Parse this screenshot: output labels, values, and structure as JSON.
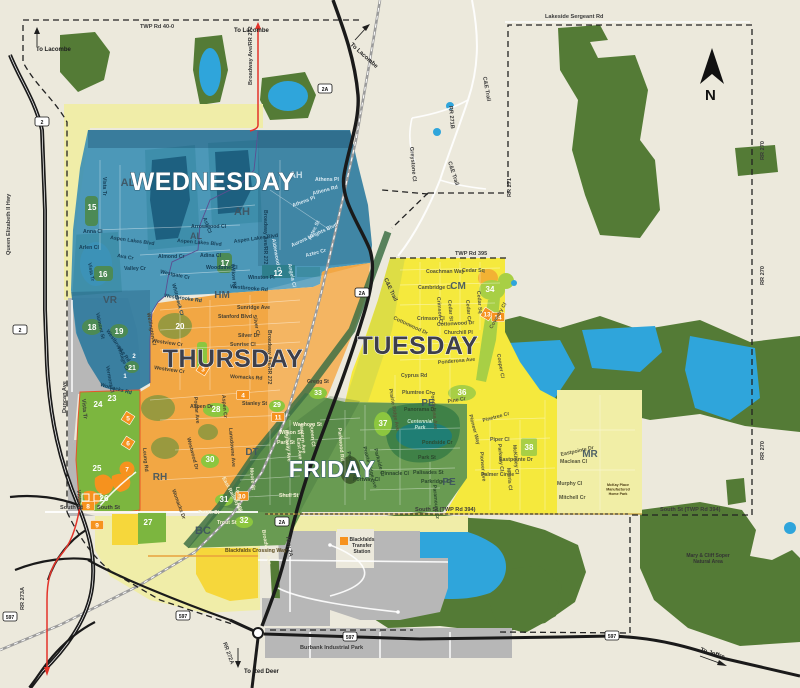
{
  "compass_letter": "N",
  "colors": {
    "background": "#ECE9DC",
    "forest": "#547B36",
    "lake": "#2FA5DB",
    "wednesday_blue": "#3E90B4",
    "thursday_orange": "#F2A744",
    "tuesday_yellow": "#F5E93D",
    "friday_green": "#699B52",
    "residential_green": "#7CB63F",
    "pale_yellow": "#F0EDA8",
    "gray": "#B7B7B7",
    "red_road": "#E33329",
    "marker_orange": "#F6921E"
  },
  "zone_titles": [
    {
      "id": "wednesday",
      "label": "WEDNESDAY",
      "x": 213,
      "y": 190,
      "size": 25,
      "style": "light"
    },
    {
      "id": "thursday",
      "label": "THURSDAY",
      "x": 233,
      "y": 367,
      "size": 25,
      "style": "dark"
    },
    {
      "id": "tuesday",
      "label": "TUESDAY",
      "x": 418,
      "y": 354,
      "size": 25,
      "style": "dark"
    },
    {
      "id": "friday",
      "label": "FRIDAY",
      "x": 332,
      "y": 477,
      "size": 23,
      "style": "light"
    }
  ],
  "area_codes": [
    {
      "t": "AL",
      "x": 128,
      "y": 186,
      "s": 11
    },
    {
      "t": "AH",
      "x": 242,
      "y": 215,
      "s": 11
    },
    {
      "t": "AH",
      "x": 296,
      "y": 178,
      "s": 9,
      "c": "w"
    },
    {
      "t": "AL",
      "x": 196,
      "y": 239,
      "s": 9
    },
    {
      "t": "VR",
      "x": 110,
      "y": 303,
      "s": 10
    },
    {
      "t": "HM",
      "x": 222,
      "y": 298,
      "s": 10
    },
    {
      "t": "RH",
      "x": 160,
      "y": 480,
      "s": 10
    },
    {
      "t": "CM",
      "x": 458,
      "y": 289,
      "s": 10
    },
    {
      "t": "PE",
      "x": 428,
      "y": 406,
      "s": 10
    },
    {
      "t": "PE",
      "x": 449,
      "y": 485,
      "s": 10
    },
    {
      "t": "DT",
      "x": 252,
      "y": 455,
      "s": 10
    },
    {
      "t": "MR",
      "x": 590,
      "y": 457,
      "s": 10
    },
    {
      "t": "BC",
      "x": 203,
      "y": 534,
      "s": 11
    }
  ],
  "park_numbers": [
    {
      "t": "15",
      "x": 92,
      "y": 210
    },
    {
      "t": "16",
      "x": 103,
      "y": 277
    },
    {
      "t": "17",
      "x": 225,
      "y": 266
    },
    {
      "t": "12",
      "x": 278,
      "y": 276
    },
    {
      "t": "18",
      "x": 92,
      "y": 330
    },
    {
      "t": "19",
      "x": 119,
      "y": 334
    },
    {
      "t": "21",
      "x": 132,
      "y": 370,
      "s": 7
    },
    {
      "t": "2",
      "x": 134,
      "y": 358,
      "s": 6
    },
    {
      "t": "1",
      "x": 125,
      "y": 378,
      "s": 6
    },
    {
      "t": "20",
      "x": 180,
      "y": 329
    },
    {
      "t": "23",
      "x": 112,
      "y": 401
    },
    {
      "t": "24",
      "x": 98,
      "y": 407
    },
    {
      "t": "25",
      "x": 97,
      "y": 471
    },
    {
      "t": "26",
      "x": 104,
      "y": 501
    },
    {
      "t": "27",
      "x": 148,
      "y": 525
    },
    {
      "t": "28",
      "x": 216,
      "y": 412
    },
    {
      "t": "29",
      "x": 277,
      "y": 407,
      "s": 7
    },
    {
      "t": "30",
      "x": 210,
      "y": 462
    },
    {
      "t": "31",
      "x": 224,
      "y": 502
    },
    {
      "t": "32",
      "x": 244,
      "y": 523
    },
    {
      "t": "33",
      "x": 318,
      "y": 395,
      "s": 7
    },
    {
      "t": "34",
      "x": 490,
      "y": 292
    },
    {
      "t": "36",
      "x": 462,
      "y": 395
    },
    {
      "t": "37",
      "x": 383,
      "y": 426
    },
    {
      "t": "38",
      "x": 529,
      "y": 450
    }
  ],
  "orange_markers": [
    {
      "t": "3",
      "x": 203,
      "y": 369,
      "shape": "diamond"
    },
    {
      "t": "5",
      "x": 128,
      "y": 418,
      "shape": "diamond"
    },
    {
      "t": "6",
      "x": 128,
      "y": 443,
      "shape": "diamond"
    },
    {
      "t": "7",
      "x": 127,
      "y": 469,
      "shape": "blob"
    },
    {
      "t": "8",
      "x": 88,
      "y": 506,
      "shape": "box"
    },
    {
      "t": "9",
      "x": 97,
      "y": 525,
      "shape": "box"
    },
    {
      "t": "4",
      "x": 243,
      "y": 395,
      "shape": "box"
    },
    {
      "t": "10",
      "x": 242,
      "y": 496,
      "shape": "box"
    },
    {
      "t": "11",
      "x": 278,
      "y": 417,
      "shape": "box"
    },
    {
      "t": "13",
      "x": 487,
      "y": 314,
      "shape": "diamond"
    },
    {
      "t": "14",
      "x": 498,
      "y": 317,
      "shape": "box"
    }
  ],
  "highway_shields": [
    {
      "t": "2",
      "x": 42,
      "y": 122
    },
    {
      "t": "2",
      "x": 20,
      "y": 330
    },
    {
      "t": "2A",
      "x": 325,
      "y": 89
    },
    {
      "t": "2A",
      "x": 362,
      "y": 293
    },
    {
      "t": "2A",
      "x": 282,
      "y": 522
    },
    {
      "t": "597",
      "x": 10,
      "y": 617
    },
    {
      "t": "597",
      "x": 183,
      "y": 616
    },
    {
      "t": "597",
      "x": 350,
      "y": 637
    },
    {
      "t": "597",
      "x": 612,
      "y": 636
    }
  ],
  "road_labels": [
    {
      "t": "TWP Rd 40-0",
      "x": 140,
      "y": 28
    },
    {
      "t": "Lakeside Sergeant Rd",
      "x": 545,
      "y": 18
    },
    {
      "t": "TWP Rd 395",
      "x": 455,
      "y": 255
    },
    {
      "t": "South St (TWP Rd 394)",
      "x": 415,
      "y": 511
    },
    {
      "t": "South St (TWP Rd 394)",
      "x": 660,
      "y": 511
    },
    {
      "t": "South St",
      "x": 60,
      "y": 509
    },
    {
      "t": "South St",
      "x": 97,
      "y": 509
    },
    {
      "t": "Queen Elizabeth II Hwy",
      "x": 10,
      "y": 255,
      "r": -90
    },
    {
      "t": "Broadway Ave/RR 272",
      "x": 252,
      "y": 85,
      "r": -90
    },
    {
      "t": "C&E Trail",
      "x": 483,
      "y": 77,
      "r": 80
    },
    {
      "t": "C&E Trail",
      "x": 448,
      "y": 162,
      "r": 72
    },
    {
      "t": "C&E Trail",
      "x": 384,
      "y": 279,
      "r": 65
    },
    {
      "t": "RR 271B",
      "x": 449,
      "y": 106,
      "r": 85
    },
    {
      "t": "RR 271",
      "x": 511,
      "y": 197,
      "r": -90
    },
    {
      "t": "RR 270",
      "x": 764,
      "y": 160,
      "r": -90
    },
    {
      "t": "RR 270",
      "x": 764,
      "y": 285,
      "r": -90
    },
    {
      "t": "RR 270",
      "x": 764,
      "y": 460,
      "r": -90
    },
    {
      "t": "RR 273A",
      "x": 24,
      "y": 610,
      "r": -90
    },
    {
      "t": "RR 272A",
      "x": 223,
      "y": 643,
      "r": 70
    },
    {
      "t": "Hwy 2A",
      "x": 286,
      "y": 537,
      "r": 80
    },
    {
      "t": "Greystone Cl",
      "x": 410,
      "y": 147,
      "r": 85
    },
    {
      "t": "Duncan Ave",
      "x": 66,
      "y": 413,
      "r": -90
    },
    {
      "t": "Vista Tr",
      "x": 82,
      "y": 399,
      "r": 85
    },
    {
      "t": "Vista Tr",
      "x": 77,
      "y": 490,
      "r": 85
    },
    {
      "t": "Burbank Industrial Park",
      "x": 300,
      "y": 649
    }
  ],
  "direction_labels": [
    {
      "t": "To Lacombe",
      "x": 36,
      "y": 51
    },
    {
      "t": "To Lacombe",
      "x": 234,
      "y": 32
    },
    {
      "t": "To Lacombe",
      "x": 350,
      "y": 45,
      "r": 42
    },
    {
      "t": "To Red Deer",
      "x": 244,
      "y": 673
    },
    {
      "t": "To Joffre",
      "x": 700,
      "y": 651,
      "r": 18
    }
  ],
  "place_labels": [
    {
      "lines": [
        "Blackfalds",
        "Transfer",
        "Station"
      ],
      "x": 362,
      "y": 541,
      "cls": "place"
    },
    {
      "lines": [
        "Mary & Cliff Soper",
        "Natural Area"
      ],
      "x": 708,
      "y": 557,
      "cls": "place"
    },
    {
      "lines": [
        "Centennial",
        "Park"
      ],
      "x": 420,
      "y": 423,
      "cls": "park-label"
    },
    {
      "lines": [
        "McKay Place",
        "Manufactured",
        "Home Park"
      ],
      "x": 618,
      "y": 486,
      "cls": "tiny"
    }
  ],
  "street_labels": [
    {
      "t": "Vista Tr",
      "x": 103,
      "y": 177,
      "r": 90,
      "c": "b"
    },
    {
      "t": "Anna Cl",
      "x": 83,
      "y": 233,
      "c": "b"
    },
    {
      "t": "Aspen Lakes Blvd",
      "x": 110,
      "y": 239,
      "r": 8,
      "c": "b"
    },
    {
      "t": "Arlen Cl",
      "x": 79,
      "y": 249,
      "c": "b"
    },
    {
      "t": "Ava Cr",
      "x": 117,
      "y": 257,
      "r": 10,
      "c": "b"
    },
    {
      "t": "Valley Cr",
      "x": 124,
      "y": 270,
      "c": "b"
    },
    {
      "t": "Vista Tr",
      "x": 88,
      "y": 263,
      "r": 80,
      "c": "b"
    },
    {
      "t": "Valmont St",
      "x": 96,
      "y": 313,
      "r": 78,
      "c": "b"
    },
    {
      "t": "Westbrooke Rd",
      "x": 106,
      "y": 331,
      "r": 55,
      "c": "b"
    },
    {
      "t": "Vintage Cl",
      "x": 117,
      "y": 347,
      "r": 70,
      "c": "b"
    },
    {
      "t": "Vermont Cl",
      "x": 106,
      "y": 366,
      "r": 80,
      "c": "b"
    },
    {
      "t": "Womacks Rd",
      "x": 100,
      "y": 386,
      "r": 15,
      "c": "b"
    },
    {
      "t": "Almond Cr",
      "x": 158,
      "y": 258,
      "c": "b"
    },
    {
      "t": "Westgate Cr",
      "x": 160,
      "y": 273,
      "r": 12,
      "c": "b"
    },
    {
      "t": "Whitebeck Cl",
      "x": 172,
      "y": 284,
      "r": 75,
      "c": "b"
    },
    {
      "t": "Westbrooke Rd",
      "x": 164,
      "y": 297,
      "r": 8,
      "c": "b"
    },
    {
      "t": "Arrowwood Cl",
      "x": 191,
      "y": 228,
      "c": "b"
    },
    {
      "t": "Ash Cl",
      "x": 203,
      "y": 218,
      "r": 70,
      "c": "b"
    },
    {
      "t": "Aspen Lakes Blvd",
      "x": 177,
      "y": 242,
      "r": 5,
      "c": "b"
    },
    {
      "t": "Adina Cl",
      "x": 200,
      "y": 257,
      "c": "b"
    },
    {
      "t": "Woodbine Cl",
      "x": 206,
      "y": 269,
      "c": "b"
    },
    {
      "t": "Willow Rd",
      "x": 231,
      "y": 264,
      "r": 85,
      "c": "b"
    },
    {
      "t": "Aspen Lakes Blvd",
      "x": 234,
      "y": 243,
      "r": -8,
      "c": "b"
    },
    {
      "t": "Winston Pl",
      "x": 248,
      "y": 279,
      "c": "b"
    },
    {
      "t": "Westbrooke Rd",
      "x": 230,
      "y": 288,
      "r": 5,
      "c": "b"
    },
    {
      "t": "Broadway Ave/RR 272",
      "x": 264,
      "y": 210,
      "r": 90,
      "c": "b"
    },
    {
      "t": "Athens Pl",
      "x": 315,
      "y": 181,
      "c": "w"
    },
    {
      "t": "Athens Rd",
      "x": 313,
      "y": 195,
      "r": -15,
      "c": "w"
    },
    {
      "t": "Athens Pl",
      "x": 293,
      "y": 207,
      "r": -20,
      "c": "w"
    },
    {
      "t": "Alderwood Cl",
      "x": 272,
      "y": 239,
      "r": 80,
      "c": "w"
    },
    {
      "t": "Aurora Heights Blvd",
      "x": 292,
      "y": 247,
      "r": -25,
      "c": "w"
    },
    {
      "t": "Aztec St",
      "x": 311,
      "y": 240,
      "r": -65,
      "c": "w"
    },
    {
      "t": "Aztec Cr",
      "x": 306,
      "y": 257,
      "r": -15,
      "c": "w"
    },
    {
      "t": "Angela Cl",
      "x": 288,
      "y": 264,
      "r": 78,
      "c": "w"
    },
    {
      "t": "Wellington Cl",
      "x": 147,
      "y": 313,
      "r": 80,
      "c": "o"
    },
    {
      "t": "Westview Cr",
      "x": 152,
      "y": 342,
      "r": 8,
      "c": "o"
    },
    {
      "t": "Westview Cr",
      "x": 154,
      "y": 369,
      "r": 8,
      "c": "o"
    },
    {
      "t": "Womacks Rd",
      "x": 230,
      "y": 378,
      "r": 3,
      "c": "o"
    },
    {
      "t": "Stanford Blvd",
      "x": 218,
      "y": 318,
      "c": "o"
    },
    {
      "t": "Sunridge Ave",
      "x": 237,
      "y": 309,
      "c": "o"
    },
    {
      "t": "Silver Dr",
      "x": 238,
      "y": 337,
      "c": "o"
    },
    {
      "t": "Sunrise Cl",
      "x": 230,
      "y": 346,
      "c": "o"
    },
    {
      "t": "Silver Cl",
      "x": 253,
      "y": 315,
      "r": 80,
      "c": "o"
    },
    {
      "t": "Gregg St",
      "x": 307,
      "y": 383,
      "c": "o"
    },
    {
      "t": "Stanley St",
      "x": 242,
      "y": 405,
      "c": "o"
    },
    {
      "t": "Aspen Dr",
      "x": 190,
      "y": 408,
      "c": "o"
    },
    {
      "t": "Poplar Ave",
      "x": 194,
      "y": 397,
      "r": 85,
      "c": "o"
    },
    {
      "t": "Aspen Cr",
      "x": 222,
      "y": 395,
      "r": 85,
      "c": "o"
    },
    {
      "t": "Lansdowne Ave",
      "x": 229,
      "y": 428,
      "r": 85,
      "c": "o"
    },
    {
      "t": "Leung Rd",
      "x": 143,
      "y": 448,
      "r": 85,
      "c": "o"
    },
    {
      "t": "Womacks Dr",
      "x": 172,
      "y": 490,
      "r": 70,
      "c": "o"
    },
    {
      "t": "Westwood Dr",
      "x": 187,
      "y": 438,
      "r": 75,
      "c": "o"
    },
    {
      "t": "Broadway Ave/RR 272",
      "x": 268,
      "y": 330,
      "r": 90,
      "c": "o"
    },
    {
      "t": "Coachman Way",
      "x": 426,
      "y": 273,
      "c": "y"
    },
    {
      "t": "Cedar Sq",
      "x": 462,
      "y": 272,
      "c": "y"
    },
    {
      "t": "Cambridge Cl",
      "x": 418,
      "y": 289,
      "c": "y"
    },
    {
      "t": "Cedar St",
      "x": 448,
      "y": 300,
      "r": 85,
      "c": "y"
    },
    {
      "t": "Cedar Cr",
      "x": 466,
      "y": 300,
      "r": 85,
      "c": "y"
    },
    {
      "t": "Cedar Sq",
      "x": 477,
      "y": 291,
      "r": 85,
      "c": "y"
    },
    {
      "t": "Crimson Cl",
      "x": 437,
      "y": 297,
      "r": 85,
      "c": "y"
    },
    {
      "t": "Crimson Cl",
      "x": 417,
      "y": 320,
      "c": "y"
    },
    {
      "t": "Cottonwood Dr",
      "x": 437,
      "y": 326,
      "r": -3,
      "c": "y"
    },
    {
      "t": "Cottonwood Dr",
      "x": 393,
      "y": 319,
      "r": 25,
      "c": "y"
    },
    {
      "t": "Churchill Pl",
      "x": 444,
      "y": 334,
      "c": "y"
    },
    {
      "t": "Coventry Cl",
      "x": 492,
      "y": 329,
      "r": -60,
      "c": "y"
    },
    {
      "t": "Cooper Cl",
      "x": 497,
      "y": 354,
      "r": 80,
      "c": "y"
    },
    {
      "t": "Cyprus Rd",
      "x": 401,
      "y": 377,
      "c": "y"
    },
    {
      "t": "Ponderosa Ave",
      "x": 438,
      "y": 364,
      "r": -5,
      "c": "y"
    },
    {
      "t": "Ponderosa Ave",
      "x": 431,
      "y": 392,
      "r": 85,
      "c": "y"
    },
    {
      "t": "Plumtree Cr",
      "x": 402,
      "y": 394,
      "c": "y"
    },
    {
      "t": "Pine Cr",
      "x": 448,
      "y": 403,
      "r": -10,
      "c": "y"
    },
    {
      "t": "Prairie Ridge Ave",
      "x": 389,
      "y": 389,
      "r": 80,
      "c": "y"
    },
    {
      "t": "Pinetree Cr",
      "x": 483,
      "y": 422,
      "r": -15,
      "c": "y"
    },
    {
      "t": "Piper Cl",
      "x": 490,
      "y": 441,
      "c": "y"
    },
    {
      "t": "Pioneer Ave",
      "x": 480,
      "y": 452,
      "r": 85,
      "c": "y"
    },
    {
      "t": "Pioneer Way",
      "x": 469,
      "y": 415,
      "r": 75,
      "c": "y"
    },
    {
      "t": "Parkway Cl",
      "x": 498,
      "y": 444,
      "r": 85,
      "c": "y"
    },
    {
      "t": "Eastpointe Dr",
      "x": 499,
      "y": 461,
      "c": "y"
    },
    {
      "t": "Eastpointe Dr",
      "x": 561,
      "y": 456,
      "r": -12,
      "c": "y"
    },
    {
      "t": "McKinley Cl",
      "x": 513,
      "y": 445,
      "r": 85,
      "c": "y"
    },
    {
      "t": "Morris Cl",
      "x": 507,
      "y": 468,
      "r": 85,
      "c": "y"
    },
    {
      "t": "Palmer Circle",
      "x": 481,
      "y": 476,
      "c": "y"
    },
    {
      "t": "Maclean Cl",
      "x": 560,
      "y": 463,
      "c": "y"
    },
    {
      "t": "Murphy Cl",
      "x": 557,
      "y": 485,
      "c": "y"
    },
    {
      "t": "Mitchell Cr",
      "x": 559,
      "y": 499,
      "c": "y"
    },
    {
      "t": "Panorama Dr",
      "x": 404,
      "y": 411,
      "c": "g"
    },
    {
      "t": "Pondside Cr",
      "x": 422,
      "y": 444,
      "c": "g"
    },
    {
      "t": "Park St",
      "x": 418,
      "y": 459,
      "c": "g"
    },
    {
      "t": "Palisades St",
      "x": 413,
      "y": 474,
      "c": "g"
    },
    {
      "t": "Parkridge Cr",
      "x": 421,
      "y": 483,
      "c": "g"
    },
    {
      "t": "Paramount Cr",
      "x": 433,
      "y": 485,
      "r": 85,
      "c": "g"
    },
    {
      "t": "Pinnacle Cl",
      "x": 381,
      "y": 475,
      "c": "g"
    },
    {
      "t": "Portway Cl",
      "x": 353,
      "y": 481,
      "c": "g"
    },
    {
      "t": "Prospect Cl",
      "x": 347,
      "y": 452,
      "r": 75,
      "c": "g"
    },
    {
      "t": "Prairie Ridge Ave",
      "x": 363,
      "y": 447,
      "r": 75,
      "c": "g"
    },
    {
      "t": "Parkside Cr",
      "x": 374,
      "y": 449,
      "r": 75,
      "c": "g"
    },
    {
      "t": "Parkwood Rd",
      "x": 338,
      "y": 428,
      "r": 85,
      "c": "c"
    },
    {
      "t": "Waghorn St",
      "x": 293,
      "y": 426,
      "c": "c"
    },
    {
      "t": "Wilson St",
      "x": 279,
      "y": 434,
      "c": "c"
    },
    {
      "t": "Park St",
      "x": 277,
      "y": 444,
      "c": "c"
    },
    {
      "t": "East Ave",
      "x": 297,
      "y": 438,
      "r": 85,
      "c": "c"
    },
    {
      "t": "Lantern Ave",
      "x": 300,
      "y": 424,
      "r": 85,
      "c": "c"
    },
    {
      "t": "Queen Cl",
      "x": 310,
      "y": 424,
      "r": 85,
      "c": "c"
    },
    {
      "t": "Highway Ave",
      "x": 285,
      "y": 430,
      "r": 85,
      "c": "c"
    },
    {
      "t": "Moore St",
      "x": 250,
      "y": 468,
      "r": 85,
      "c": "c"
    },
    {
      "t": "Lorne Ave",
      "x": 236,
      "y": 487,
      "r": 85,
      "c": "c"
    },
    {
      "t": "Shull St",
      "x": 279,
      "y": 497,
      "c": "c"
    },
    {
      "t": "Trout St",
      "x": 217,
      "y": 524,
      "c": "c"
    },
    {
      "t": "South St",
      "x": 198,
      "y": 514,
      "c": "c"
    },
    {
      "t": "Broadway Ave",
      "x": 262,
      "y": 530,
      "r": 80,
      "c": "c"
    },
    {
      "t": "East Railway St",
      "x": 222,
      "y": 478,
      "r": 62,
      "c": "c"
    },
    {
      "t": "Blackfalds Crossing Way",
      "x": 225,
      "y": 552,
      "c": "d"
    }
  ]
}
